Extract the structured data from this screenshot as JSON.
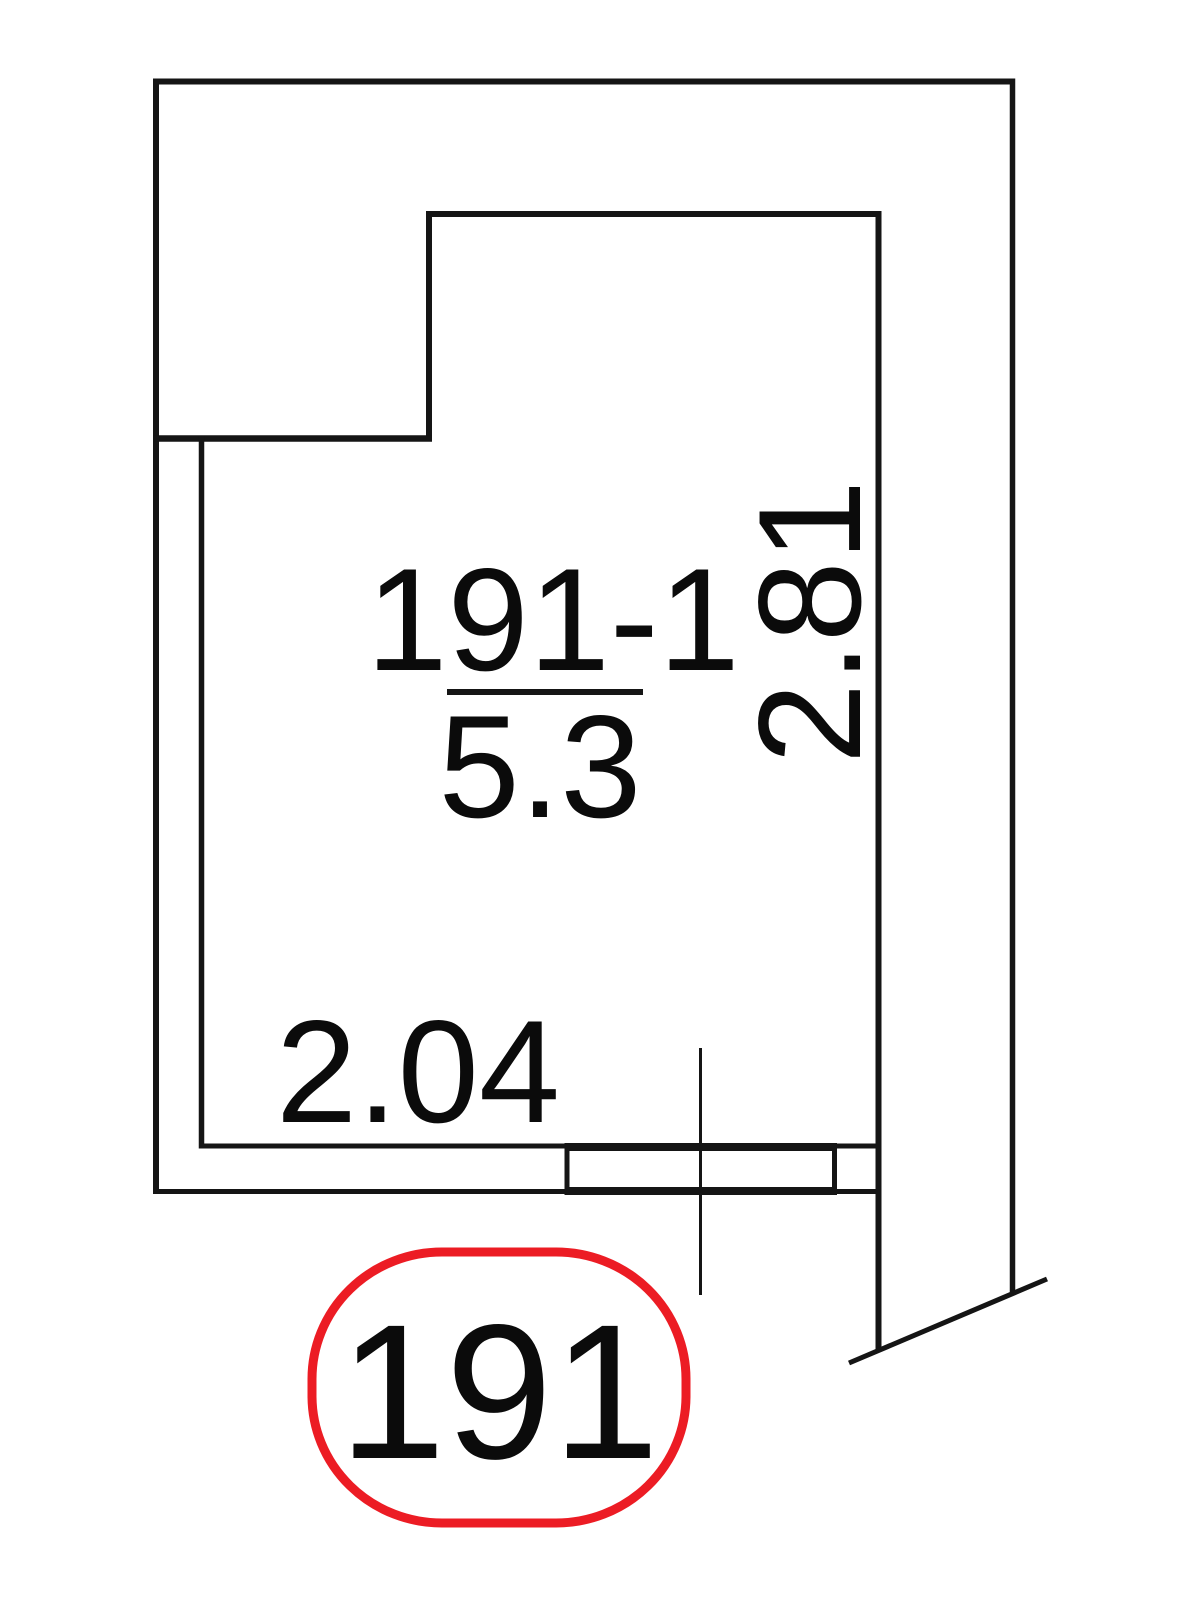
{
  "plan": {
    "room": {
      "number": "191-1",
      "area": "5.3"
    },
    "dimensions": {
      "width_label": "2.04",
      "height_label": "2.81"
    },
    "badge": {
      "unit_number": "191",
      "outline_color": "#ec1c24"
    },
    "line_color": "#151515",
    "text_color": "#0b0b0b",
    "background": "#ffffff"
  }
}
